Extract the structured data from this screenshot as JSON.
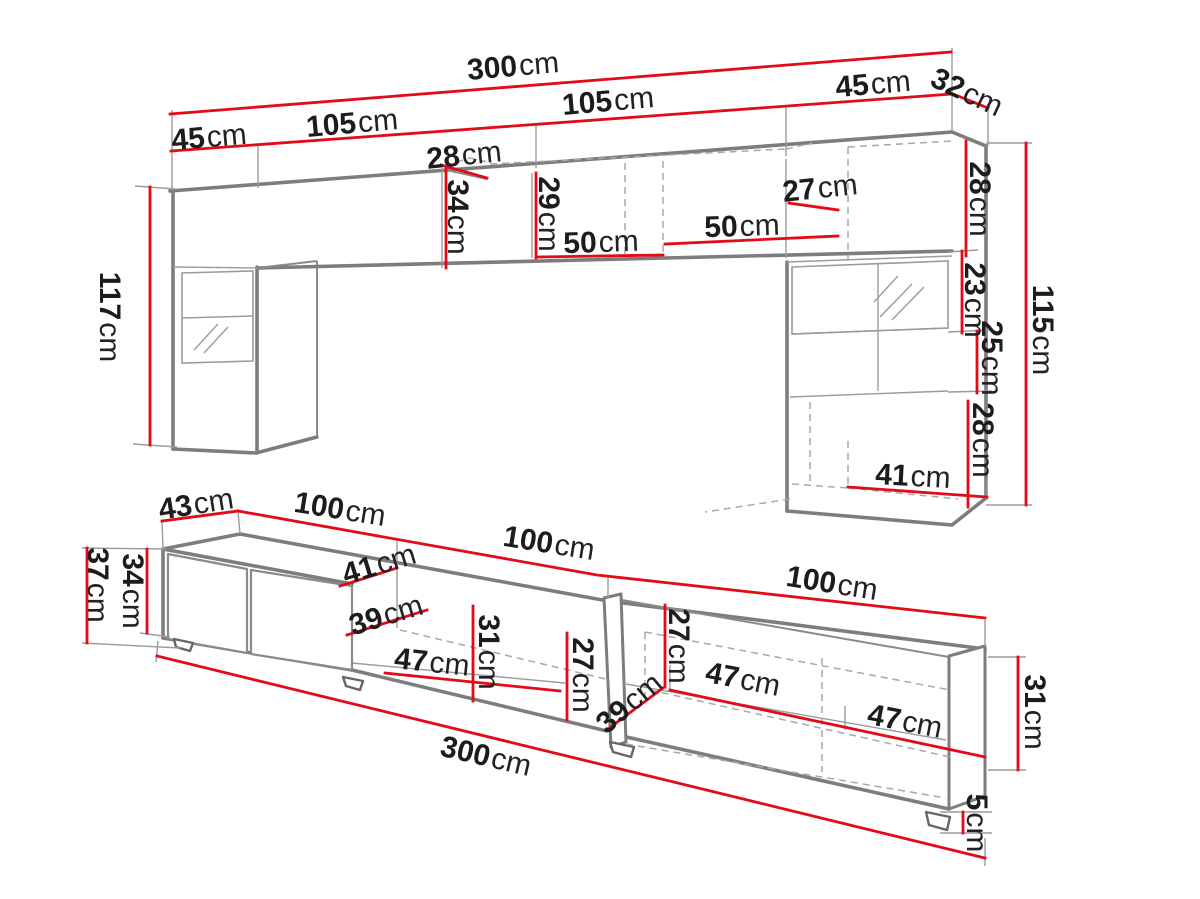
{
  "meta": {
    "unit_suffix": "cm",
    "colors": {
      "dimension_red": "#e30b17",
      "outline_gray": "#7d7d7d",
      "label_black": "#1c1c1c",
      "background": "#ffffff"
    }
  },
  "diagram": {
    "top_view": {
      "labels": [
        {
          "num": "300",
          "unit": "cm"
        },
        {
          "num": "45",
          "unit": "cm"
        },
        {
          "num": "105",
          "unit": "cm"
        },
        {
          "num": "105",
          "unit": "cm"
        },
        {
          "num": "45",
          "unit": "cm"
        },
        {
          "num": "32",
          "unit": "cm"
        },
        {
          "num": "28",
          "unit": "cm"
        },
        {
          "num": "34",
          "unit": "cm"
        },
        {
          "num": "29",
          "unit": "cm"
        },
        {
          "num": "50",
          "unit": "cm"
        },
        {
          "num": "50",
          "unit": "cm"
        },
        {
          "num": "27",
          "unit": "cm"
        },
        {
          "num": "28",
          "unit": "cm"
        },
        {
          "num": "23",
          "unit": "cm"
        },
        {
          "num": "25",
          "unit": "cm"
        },
        {
          "num": "28",
          "unit": "cm"
        },
        {
          "num": "115",
          "unit": "cm"
        },
        {
          "num": "117",
          "unit": "cm"
        },
        {
          "num": "41",
          "unit": "cm"
        }
      ]
    },
    "bottom_view": {
      "labels": [
        {
          "num": "43",
          "unit": "cm"
        },
        {
          "num": "100",
          "unit": "cm"
        },
        {
          "num": "100",
          "unit": "cm"
        },
        {
          "num": "100",
          "unit": "cm"
        },
        {
          "num": "37",
          "unit": "cm"
        },
        {
          "num": "34",
          "unit": "cm"
        },
        {
          "num": "41",
          "unit": "cm"
        },
        {
          "num": "39",
          "unit": "cm"
        },
        {
          "num": "47",
          "unit": "cm"
        },
        {
          "num": "31",
          "unit": "cm"
        },
        {
          "num": "27",
          "unit": "cm"
        },
        {
          "num": "39",
          "unit": "cm"
        },
        {
          "num": "27",
          "unit": "cm"
        },
        {
          "num": "47",
          "unit": "cm"
        },
        {
          "num": "47",
          "unit": "cm"
        },
        {
          "num": "31",
          "unit": "cm"
        },
        {
          "num": "5",
          "unit": "cm"
        },
        {
          "num": "300",
          "unit": "cm"
        }
      ]
    }
  }
}
